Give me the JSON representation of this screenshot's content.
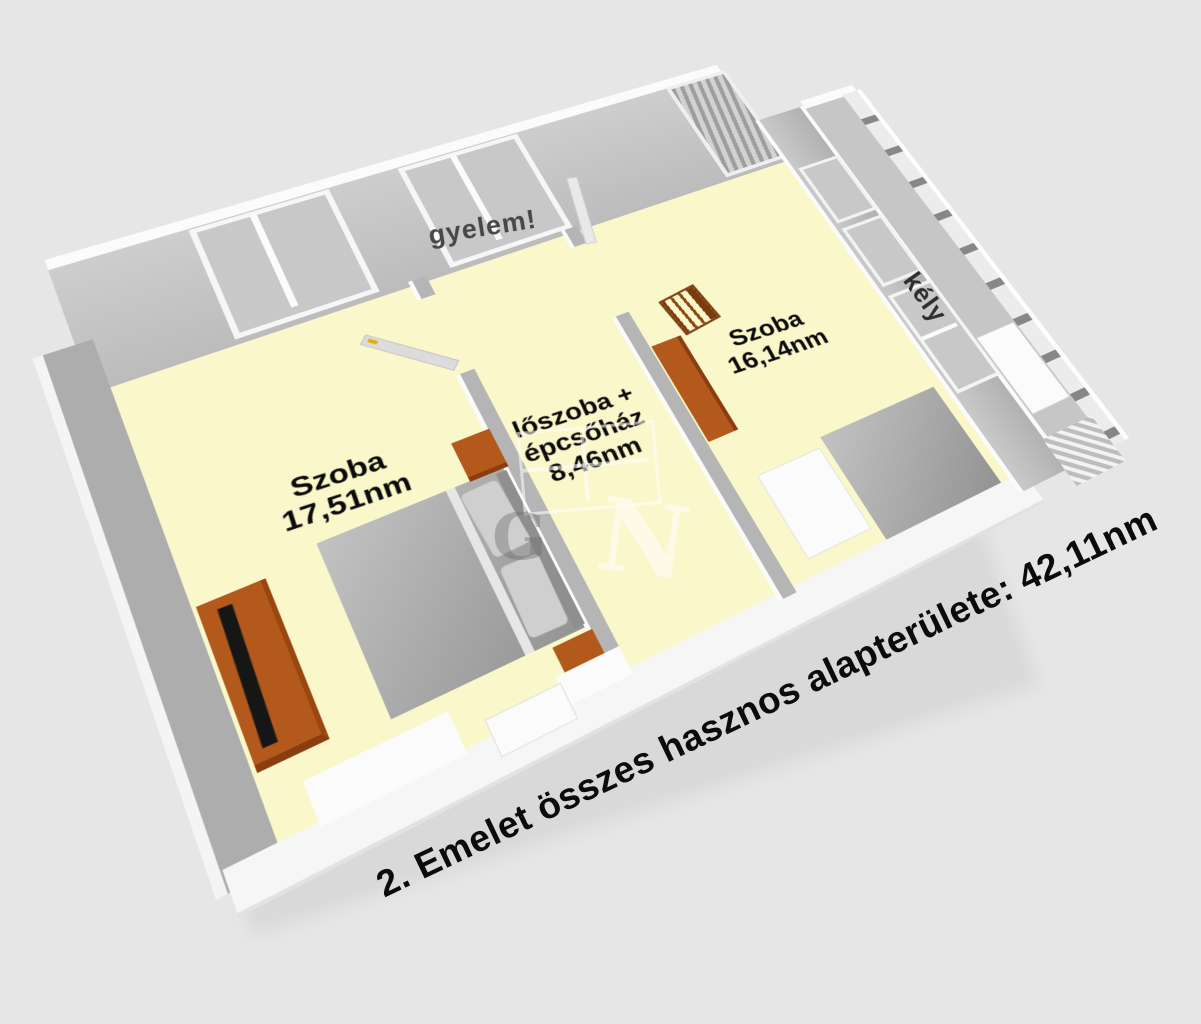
{
  "caption": "2. Emelet összes hasznos alapterülete: 42,11nm",
  "rooms": [
    {
      "name": "room-1",
      "lines": [
        "Szoba",
        "17,51nm"
      ]
    },
    {
      "name": "hallway-staircase",
      "lines": [
        "lőszoba +",
        "épcsőház",
        "8,46nm"
      ]
    },
    {
      "name": "room-2",
      "lines": [
        "Szoba",
        "16,14nm"
      ]
    }
  ],
  "watermarks": {
    "wall_text": "gyelem!",
    "balcony_door_text": "kély",
    "logo_letters": [
      "G",
      "N"
    ]
  },
  "colors": {
    "background": "#E6E6E6",
    "floor": "#FAF7CB",
    "wall": "#B5B5B5",
    "furniture_wood": "#B4591C",
    "label_text": "#0B0B0B",
    "caption_text": "#0B0B0B"
  }
}
